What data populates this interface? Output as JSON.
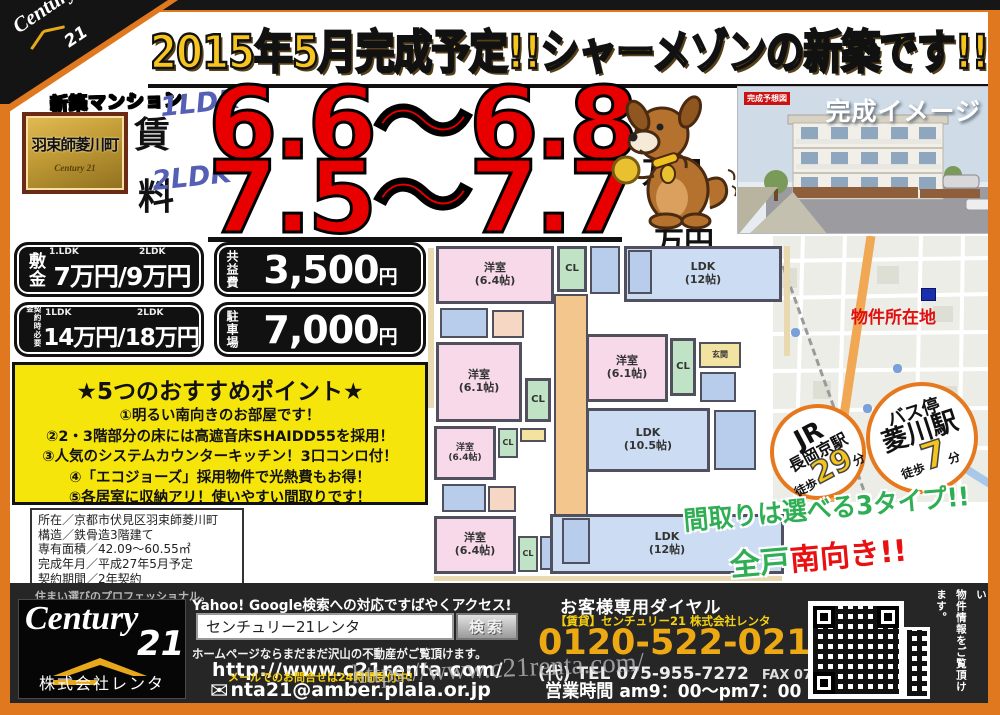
{
  "banner": {
    "title": "2015年5月完成予定!!シャーメゾンの新築です!!"
  },
  "corner": {
    "brand_script": "Century",
    "brand_num": "21"
  },
  "badge": {
    "tag": "新築マンション",
    "name": "羽束師菱川町",
    "logo": "Century 21"
  },
  "rent": {
    "label_top": "賃",
    "label_bottom": "料",
    "row1": {
      "type": "1LDK",
      "price": "6.6～6.8",
      "unit": "万円"
    },
    "row2": {
      "type": "2LDK",
      "price": "7.5～7.7",
      "unit": "万円"
    }
  },
  "render": {
    "tag": "完成予想図",
    "caption": "完成イメージ"
  },
  "map": {
    "marker_label": "物件所在地"
  },
  "fees": {
    "shikikin": {
      "label": "敷金",
      "type1": "1.LDK",
      "type2": "2LDK",
      "value": "7万円/9万円"
    },
    "kyoekihi": {
      "label": "共益費",
      "amount": "3,500",
      "unit": "円"
    },
    "keiyaku": {
      "label": "契約時必要金",
      "type1": "1LDK",
      "type2": "2LDK",
      "value": "14万円/18万円"
    },
    "parking": {
      "label": "駐車場",
      "amount": "7,000",
      "unit": "円"
    }
  },
  "points": {
    "title": "★5つのおすすめポイント★",
    "items": [
      "①明るい南向きのお部屋です！",
      "②2・3階部分の床には高遮音床SHAIDD55を採用！",
      "③人気のシステムカウンターキッチン！3口コンロ付！",
      "④「エコジョーズ」採用物件で光熱費もお得！",
      "⑤各居室に収納アリ！使いやすい間取りです！"
    ]
  },
  "details": {
    "lines": [
      "所在／京都市伏見区羽束師菱川町",
      "構造／鉄骨造3階建て",
      "専有面積／42.09～60.55㎡",
      "完成年月／平成27年5月予定",
      "契約期間／2年契約"
    ]
  },
  "floorplan": {
    "rooms": [
      {
        "label": "洋室",
        "size": "(6.4帖)"
      },
      {
        "label": "CL"
      },
      {
        "label": "LDK",
        "size": "(12帖)"
      },
      {
        "label": "洋室",
        "size": "(6.1帖)"
      },
      {
        "label": "CL"
      },
      {
        "label": "洋室",
        "size": "(6.1帖)"
      },
      {
        "label": "CL"
      },
      {
        "label": "玄関"
      },
      {
        "label": "LDK",
        "size": "(10.5帖)"
      },
      {
        "label": "洋室",
        "size": "(6.4帖)"
      },
      {
        "label": "CL"
      },
      {
        "label": "洋室",
        "size": "(6.4帖)"
      },
      {
        "label": "CL"
      },
      {
        "label": "LDK",
        "size": "(12帖)"
      }
    ]
  },
  "access": {
    "jr": {
      "line1": "JR",
      "line2": "長岡京駅",
      "walk": "徒歩",
      "minutes": "29",
      "min_unit": "分"
    },
    "bus": {
      "line1": "バス停",
      "line2": "菱川駅",
      "walk": "徒歩",
      "minutes": "7",
      "min_unit": "分"
    }
  },
  "catch": {
    "line1": "間取りは選べる3タイプ!!",
    "line2_green": "全戸",
    "line2_red": "南向き!!"
  },
  "icons": {
    "envelope": "✉"
  },
  "footer": {
    "slogan": "住まい選びのプロフェッショナル。",
    "company": "株式会社レンタ",
    "search_title": "Yahoo! Google検索への対応ですばやくアクセス!",
    "search_value": "センチュリー21レンタ",
    "search_button": "検索",
    "hp_note": "ホームページならまだまだ沢山の不動産がご覧頂けます。",
    "url": "http://www.c21renta.com/",
    "mail_note": "メールでのお問合せは24時間受付中!",
    "email": "nta21@amber.plala.or.jp",
    "dial_title": "お客様専用ダイヤル",
    "dial_sub": "【賃貸】センチュリー21 株式会社レンタ",
    "freedial": "0120-522-021",
    "tel": "(代) TEL 075-955-7272",
    "fax": "FAX 075-955-7676",
    "hours": "営業時間 am9：00～pm7：00",
    "qr_note1": "こちらからでも詳しい",
    "qr_note2": "物件情報をご覧頂けます。",
    "watermark": "https://www.c21renta.com/"
  }
}
